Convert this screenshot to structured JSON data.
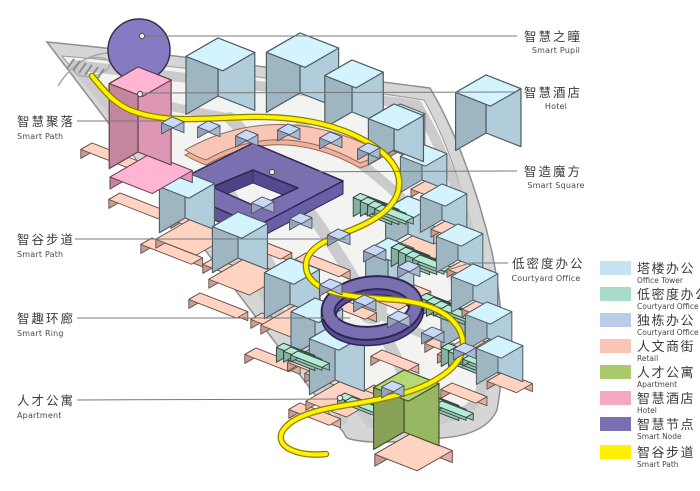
{
  "figure": {
    "type": "axonometric-smart-campus-site-plan",
    "background": "#ffffff"
  },
  "map_colors": {
    "site_band": "#d6d6d6",
    "site_interior": "#f3f3f2",
    "road": "#cbcbcb",
    "outline": "#8f8f8f"
  },
  "callouts": {
    "right": [
      {
        "zh": "智慧之瞳",
        "en": "Smart Pupil"
      },
      {
        "zh": "智慧酒店",
        "en": "Hotel"
      },
      {
        "zh": "智造魔方",
        "en": "Smart Square"
      },
      {
        "zh": "低密度办公",
        "en": "Courtyard Office"
      }
    ],
    "left": [
      {
        "zh": "智慧聚落",
        "en": "Smart Path"
      },
      {
        "zh": "智谷步道",
        "en": "Smart Path"
      },
      {
        "zh": "智趣环廊",
        "en": "Smart Ring"
      },
      {
        "zh": "人才公寓",
        "en": "Apartment"
      }
    ]
  },
  "legend": {
    "items": [
      {
        "zh": "塔楼办公",
        "en": "Office Tower",
        "color": "#c5e3f2"
      },
      {
        "zh": "低密度办公",
        "en": "Courtyard Office",
        "color": "#a8dcc8"
      },
      {
        "zh": "独栋办公",
        "en": "Courtyard Office",
        "color": "#bccbe8"
      },
      {
        "zh": "人文商街",
        "en": "Retail",
        "color": "#f9c5b4"
      },
      {
        "zh": "人才公寓",
        "en": "Apartment",
        "color": "#a9cb6d"
      },
      {
        "zh": "智慧酒店",
        "en": "Hotel",
        "color": "#f5a8c6"
      },
      {
        "zh": "智慧节点",
        "en": "Smart Node",
        "color": "#7a6fb0"
      },
      {
        "zh": "智谷步道",
        "en": "Smart Path",
        "color": "#fff100"
      }
    ]
  }
}
